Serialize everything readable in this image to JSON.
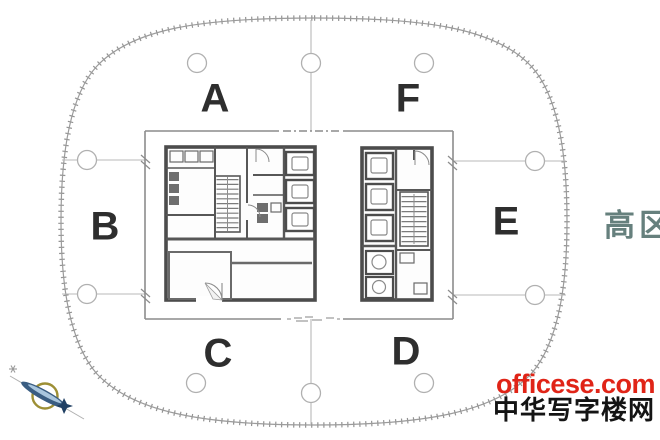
{
  "plan": {
    "zones": [
      {
        "id": "A",
        "label": "A"
      },
      {
        "id": "B",
        "label": "B"
      },
      {
        "id": "C",
        "label": "C"
      },
      {
        "id": "D",
        "label": "D"
      },
      {
        "id": "E",
        "label": "E"
      },
      {
        "id": "F",
        "label": "F"
      }
    ],
    "side_note": {
      "text": "高区",
      "color": "#66807d"
    },
    "icons": [
      {
        "name": "compass-north-icon"
      },
      {
        "name": "grid-bubble"
      },
      {
        "name": "stair-icon"
      },
      {
        "name": "elevator-icon"
      },
      {
        "name": "door-swing-icon"
      }
    ]
  },
  "watermark": {
    "site": "officese.com",
    "site_color": "#e02417",
    "name": "中华写字楼网",
    "name_color": "#141414"
  },
  "colors": {
    "outline": "#9b9b9b",
    "grid": "#b8b8b8",
    "frame": "#8c8c8c",
    "wall": "#4c4c4c",
    "label": "#2e2e2e",
    "compass_ring": "#9d8f35",
    "compass_needle": "#3a5d82"
  }
}
